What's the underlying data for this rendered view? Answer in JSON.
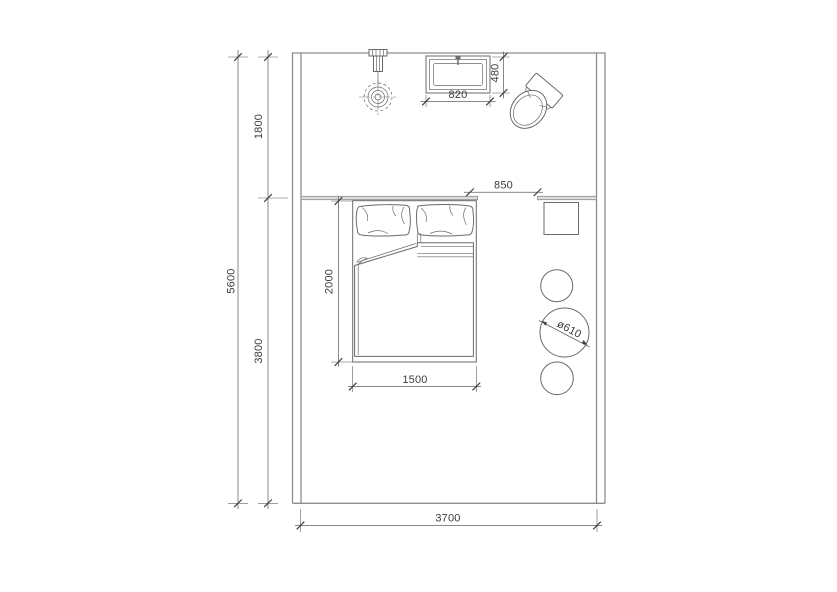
{
  "drawing": {
    "kind": "bedroom-floor-plan",
    "colors": {
      "background": "#ffffff",
      "wall_line": "#8d8d8d",
      "furniture_line": "#6a6a6a",
      "dimension_line": "#606060",
      "text": "#3c3c3c"
    }
  },
  "dimensions": {
    "total_depth": "5600",
    "upper_zone_depth": "1800",
    "lower_zone_depth": "3800",
    "room_width": "3700",
    "bed_length": "2000",
    "bed_width": "1500",
    "passage_width": "850",
    "basin_width": "820",
    "basin_depth": "480",
    "table_diameter": "ø610"
  },
  "fixtures": {
    "lamp": "pendant-lamp",
    "basin": "wash-basin",
    "toilet": "toilet",
    "bed": "double-bed",
    "nightstand": "bedside-table",
    "round_table": "round-table",
    "stool_top": "stool",
    "stool_bottom": "stool"
  }
}
